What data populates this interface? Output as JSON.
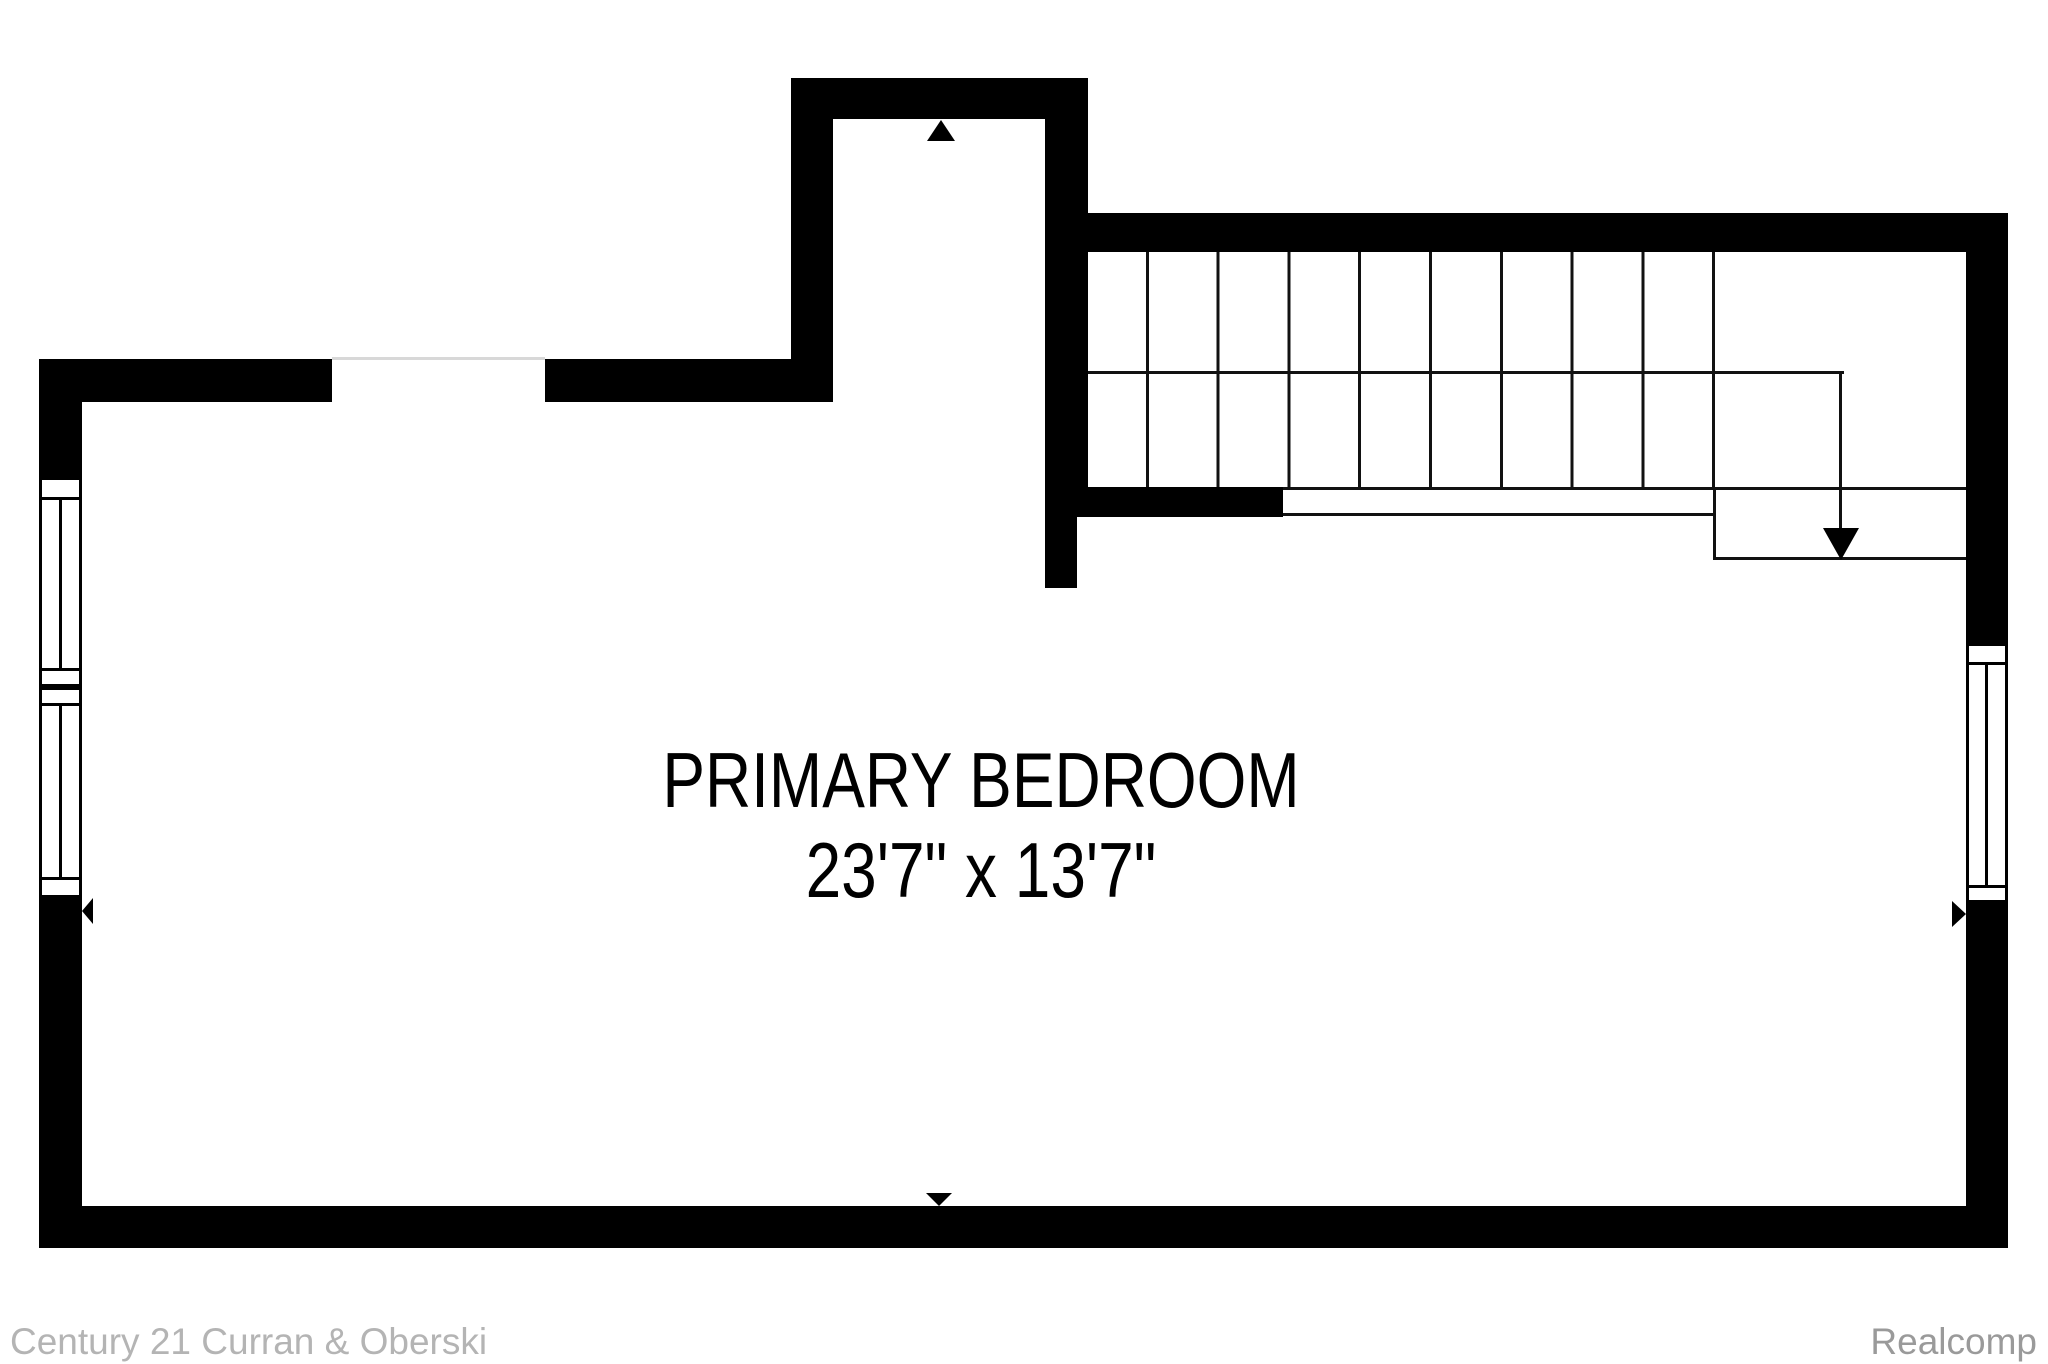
{
  "plan": {
    "type": "floor-plan",
    "room": {
      "name": "PRIMARY BEDROOM",
      "dimensions": "23'7\" x 13'7\""
    },
    "stairs": {
      "flights": 2,
      "treads_per_flight": 9,
      "direction_marker": "down-arrow"
    },
    "windows": [
      "left-wall-window-upper",
      "left-wall-window-lower",
      "right-wall-window"
    ],
    "door_opening": "top-left-wall"
  },
  "footer": {
    "left_attribution": "Century 21 Curran & Oberski",
    "right_attribution": "Realcomp"
  },
  "colors": {
    "wall": "#000000",
    "paper": "#ffffff",
    "stairline": "#111111",
    "openingline": "#d8d8d8",
    "footerleft": "#b4b4b4",
    "footerright": "#9a9a9a",
    "label": "#000000"
  }
}
